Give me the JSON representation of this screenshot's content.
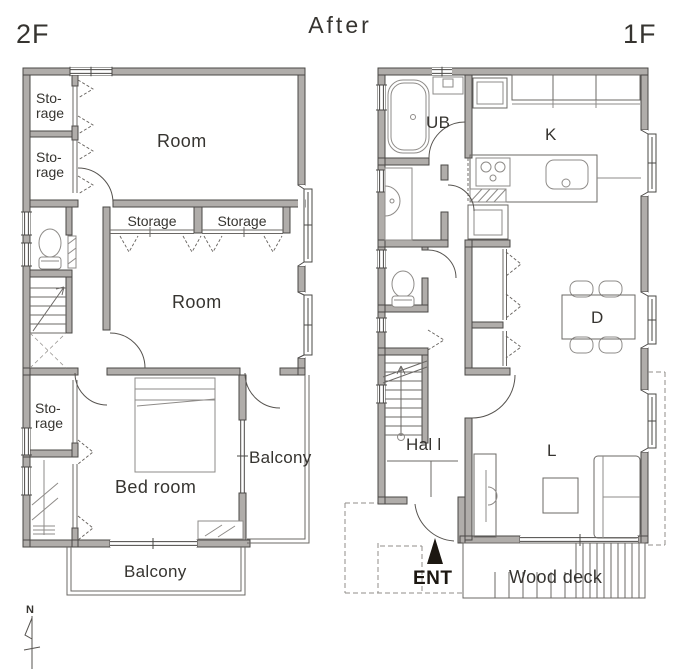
{
  "title": "After",
  "plan2f": {
    "floor_label": "2F",
    "storage_top_1": "Sto-",
    "storage_top_2": "rage",
    "storage_mid_1": "Sto-",
    "storage_mid_2": "rage",
    "storage_low_1": "Sto-",
    "storage_low_2": "rage",
    "room_upper": "Room",
    "closet_a": "Storage",
    "closet_b": "Storage",
    "room_lower": "Room",
    "bedroom": "Bed room",
    "balcony_side": "Balcony",
    "balcony_bottom": "Balcony"
  },
  "plan1f": {
    "floor_label": "1F",
    "unit_bath": "UB",
    "kitchen": "K",
    "dining": "D",
    "living": "L",
    "hall": "Hal l",
    "entrance": "ENT",
    "wood_deck": "Wood deck"
  },
  "compass": {
    "north": "N"
  },
  "colors": {
    "wall_fill": "#b0adaa",
    "wall_outline": "#4a4846",
    "entrance_marker": "#1c1711"
  }
}
